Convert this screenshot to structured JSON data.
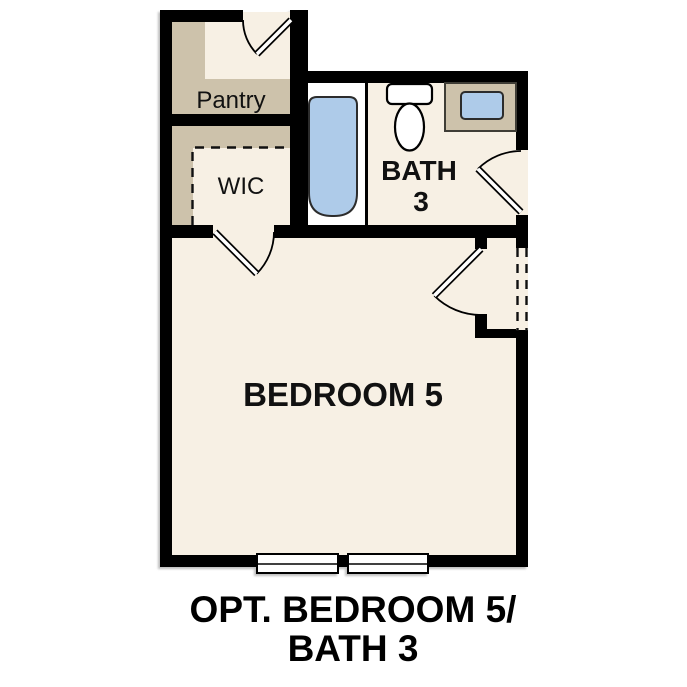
{
  "title": "Optional Bedroom 5 / Bath 3 floor plan detail",
  "rooms": {
    "pantry": {
      "label": "Pantry"
    },
    "wic": {
      "label": "WIC"
    },
    "bath": {
      "label_line1": "BATH",
      "label_line2": "3"
    },
    "bedroom": {
      "label": "BEDROOM 5"
    }
  },
  "caption": {
    "line1": "OPT. BEDROOM 5/",
    "line2": "BATH 3"
  },
  "fixtures": [
    "bathtub",
    "toilet",
    "sink-vanity"
  ],
  "features": [
    "pantry-door",
    "wic-door",
    "bath-door",
    "bedroom-door",
    "two-windows",
    "dashed-optional-opening"
  ],
  "colors": {
    "wall": "#000000",
    "cream": "#f7f0e4",
    "tan": "#cdc2ab",
    "blue": "#aecbe9",
    "white": "#ffffff",
    "text": "#111111"
  }
}
